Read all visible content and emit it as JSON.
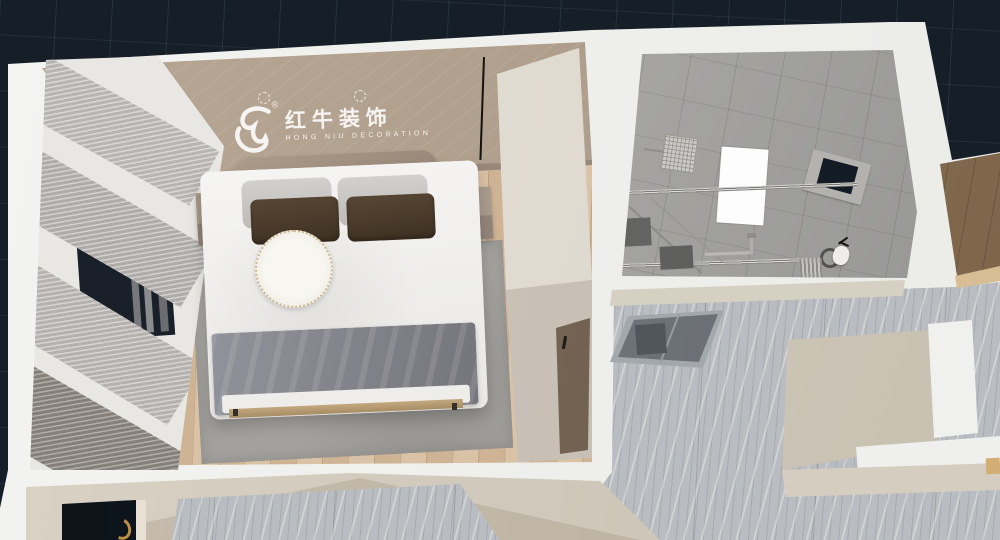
{
  "viewport": {
    "type": "3d-interior-top-down-render",
    "background_color": "#161e27",
    "grid_color": "#2a3440"
  },
  "watermark": {
    "icon": "hongniu-bull-logo",
    "registered": "®",
    "brand_cn": "红牛装饰",
    "brand_en": "HONG NIU DECORATION",
    "color": "rgba(255,255,255,0.88)"
  },
  "rooms": {
    "bedroom": {
      "label": "bedroom",
      "floor": "light wood planks",
      "ceiling_downlights": 2,
      "objects": [
        "double bed",
        "white duvet",
        "gray pillows x2",
        "dark brown pillows x2",
        "round white tray",
        "gray throw blanket",
        "gray area rug",
        "nightstand left",
        "nightstand right",
        "layered curtains",
        "window",
        "built-in wardrobe",
        "entry door brown"
      ]
    },
    "bathroom": {
      "label": "bathroom",
      "finish": "gray cement tile",
      "objects": [
        "rain shower head",
        "shower arm",
        "glass partition rails",
        "drain mats x2",
        "white light well",
        "window",
        "towel pipe",
        "toilet",
        "towel radiator",
        "sliding glass door"
      ]
    },
    "hallway": {
      "label": "hallway",
      "floor": "gray marble tile"
    },
    "side_room": {
      "label": "adjacent room",
      "floor": "brown wood",
      "threshold": "tan strip"
    },
    "lower_room": {
      "label": "lower room",
      "objects": [
        "dark doorway",
        "brass door handle"
      ]
    }
  },
  "colors": {
    "wall_white": "#f1f1ef",
    "ceiling_tan": "#b2a190",
    "wall_taupe": "#97887a",
    "wood_floor": "#d7bd9e",
    "rug_gray": "#a3a19d",
    "duvet_white": "#f2f1ee",
    "pillow_gray": "#c9c8c5",
    "pillow_brown": "#47382a",
    "blanket_gray": "#85848c",
    "headboard": "#a39281",
    "wardrobe_cream": "#e0dbd1",
    "door_brown": "#7a6958",
    "curtain_light": "#c7c5c2",
    "curtain_dark": "#8e8882",
    "window_dark": "#19202a",
    "bath_gray": "#a9a8a5",
    "lightwell_white": "#fdfdfd",
    "marble_gray": "#b9bcc0",
    "sideroom_brown": "#8b7156",
    "beige_wall": "#d2cabc",
    "entry_door_dark": "#10151d",
    "brass_handle": "#bd8f44"
  }
}
